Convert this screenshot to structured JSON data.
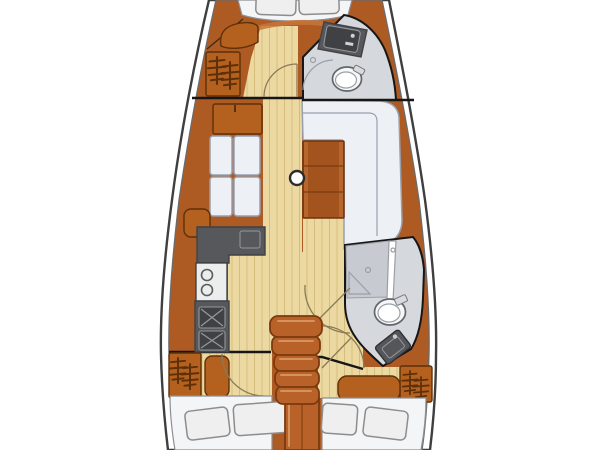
{
  "scene": {
    "type": "sailboat-interior-floor-plan",
    "orientation": "bow-at-top",
    "rooms": [
      "v-berth-forward-cabin",
      "forward-head",
      "saloon",
      "galley",
      "aft-head",
      "companionway",
      "port-aft-cabin",
      "starboard-aft-cabin"
    ],
    "fixtures": [
      "v-berth-pillows",
      "forward-hanging-locker",
      "forward-head-sink",
      "forward-head-toilet",
      "saloon-sideboard",
      "saloon-port-settee",
      "saloon-armrest",
      "saloon-table",
      "saloon-l-settee",
      "mast-post",
      "galley-counter",
      "galley-double-sink",
      "galley-stove",
      "aft-head-shower",
      "aft-head-toilet",
      "aft-head-sink",
      "companionway-steps",
      "port-aft-hanging-locker",
      "starboard-aft-hanging-locker",
      "port-aft-berth",
      "starboard-aft-berth",
      "door-swing-arcs"
    ]
  },
  "colors": {
    "bg": "#ffffff",
    "hull_line": "#3f3f3f",
    "hull_inner_line": "#6b6b6b",
    "wood": "#ae5a23",
    "wood_light": "#c8763a",
    "wood_dark": "#5f3008",
    "furniture": "#b4611f",
    "floor": "#ecd9a2",
    "plank": "#d6bd7c",
    "counter": "#56585b",
    "counter_dark": "#3f4144",
    "counter_line": "#94979c",
    "white_fixture": "#f6f7f8",
    "head_floor": "#d5d8dc",
    "shower": "#c7cbd1",
    "cushion": "#edf0f5",
    "cushion_line": "#98a0ae",
    "table": "#a2531e",
    "table_line": "#6e340d",
    "berth": "#f4f5f6",
    "pillow": "#efefef",
    "pillow_line": "#8d8d8d",
    "bulkhead": "#161616",
    "steps": "#b8622a",
    "steps_dark": "#7b3a0e",
    "steps_light": "#d6925b",
    "arc": "#8a7a57"
  }
}
